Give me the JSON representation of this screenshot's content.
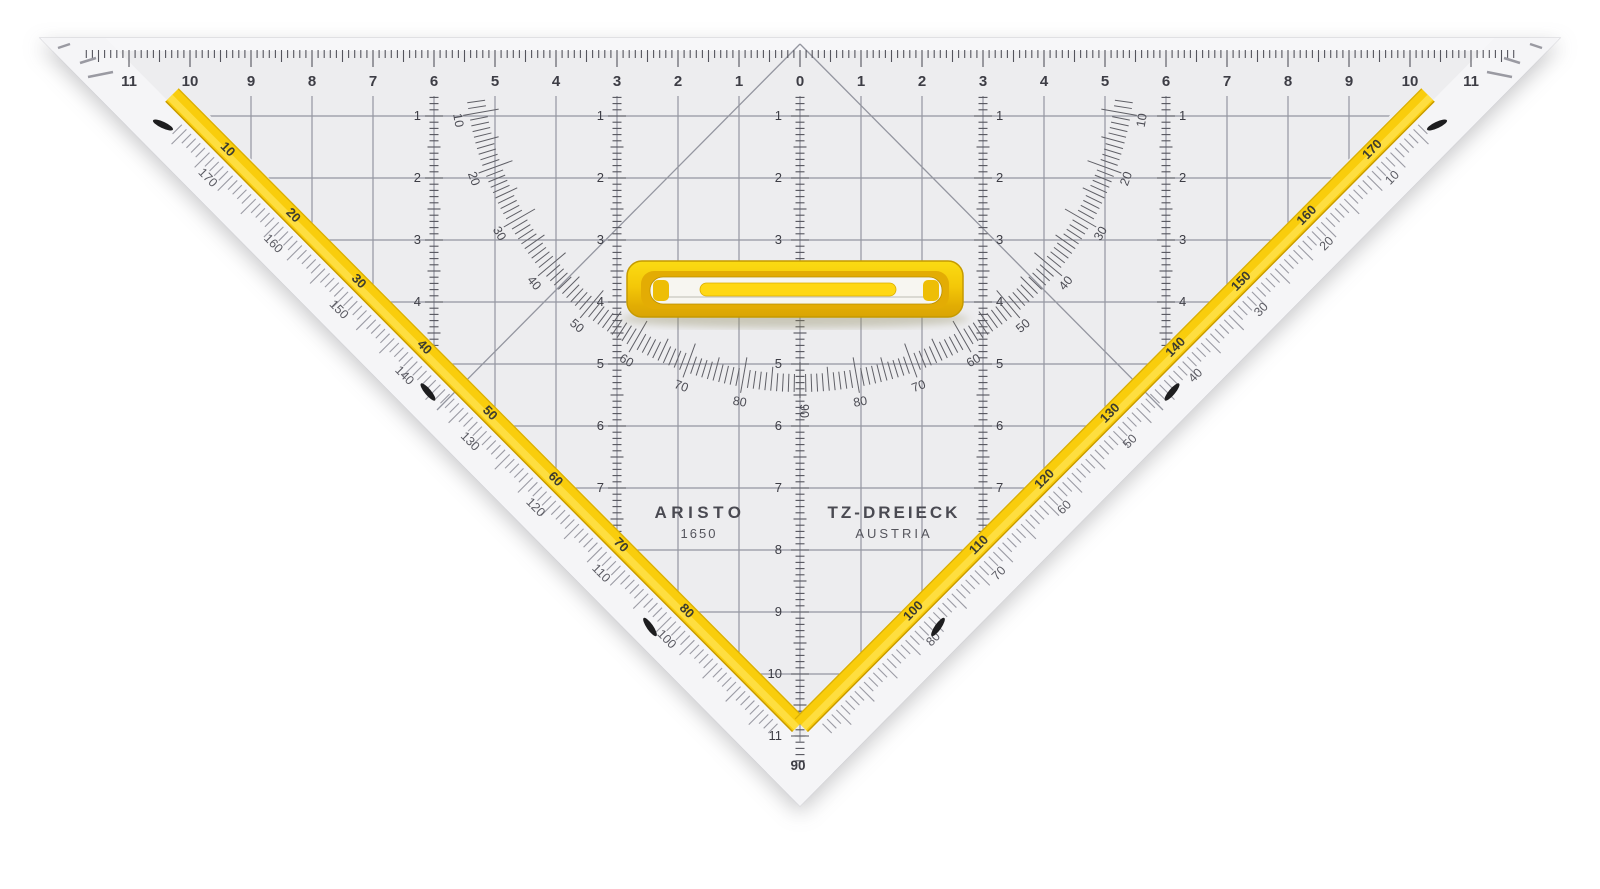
{
  "product": {
    "brand": "ARISTO",
    "model": "1650",
    "name": "TZ-DREIECK",
    "country": "AUSTRIA"
  },
  "top_ruler": {
    "cm_labels": [
      "11",
      "10",
      "9",
      "8",
      "7",
      "6",
      "5",
      "4",
      "3",
      "2",
      "1",
      "0",
      "1",
      "2",
      "3",
      "4",
      "5",
      "6",
      "7",
      "8",
      "9",
      "10",
      "11"
    ]
  },
  "protractor": {
    "arc_labels": [
      "10",
      "20",
      "30",
      "40",
      "50",
      "60",
      "70",
      "80",
      "90",
      "80",
      "70",
      "60",
      "50",
      "40",
      "30",
      "20",
      "10"
    ],
    "left_edge_strip_labels": [
      "10",
      "20",
      "30",
      "40",
      "50",
      "60",
      "70",
      "80"
    ],
    "left_edge_outer_labels": [
      "170",
      "160",
      "150",
      "140",
      "130",
      "120",
      "110",
      "100"
    ],
    "right_edge_strip_labels": [
      "170",
      "160",
      "150",
      "140",
      "130",
      "120",
      "110",
      "100"
    ],
    "right_edge_outer_labels": [
      "10",
      "20",
      "30",
      "40",
      "50",
      "60",
      "70",
      "80"
    ],
    "apex_label": "90"
  },
  "vertical_scales": {
    "center_labels": [
      "1",
      "2",
      "3",
      "4",
      "5",
      "6",
      "7",
      "8",
      "9",
      "10",
      "11"
    ],
    "inner_labels": [
      "1",
      "2",
      "3",
      "4",
      "5",
      "6",
      "7"
    ],
    "outer_labels": [
      "1",
      "2",
      "3",
      "4"
    ]
  },
  "colors": {
    "body": "#ededef",
    "bevel": "#f6f6f8",
    "grid": "#9496a0",
    "tick": "#54545c",
    "number": "#3d3d45",
    "arc_label": "#4c4c54",
    "yellow_strip": "#f9cd0c",
    "yellow_strip_light": "#ffe24a",
    "yellow_edge": "#c79a00",
    "handle_top": "#fbdb13",
    "handle_mid": "#f4c808",
    "handle_deep": "#d9a404",
    "handle_border": "#c59a00",
    "slot": "#f7f6f1",
    "mark": "#1d1d1f"
  }
}
